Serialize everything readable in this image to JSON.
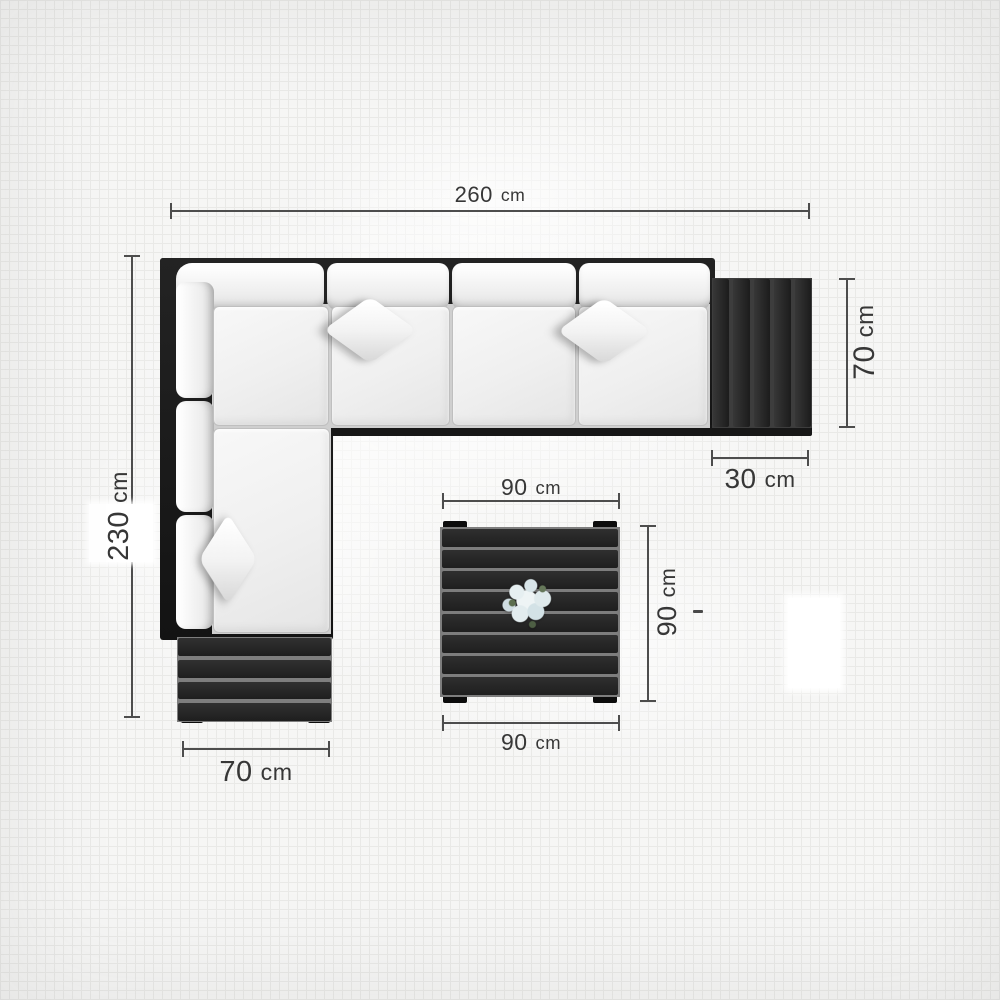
{
  "diagram": {
    "type": "furniture-top-view-dimension-diagram",
    "items": [
      "corner-sofa",
      "side-table",
      "ottoman-bench",
      "coffee-table",
      "flower-bouquet"
    ],
    "colors": {
      "background": "#f6f6f5",
      "grid_line": "#e9e9e7",
      "frame_black": "#1a1a1a",
      "cushion_white": "#f2f2f2",
      "slat_gap_gray": "#7d7d7d",
      "dimension_line": "#4d4d4d",
      "label_text": "#373737",
      "flower_pale_blue": "#dfeaec",
      "flower_green": "#5c6e4e"
    },
    "labels": {
      "sofa_total_width": {
        "value": "260",
        "unit": "cm"
      },
      "sofa_total_depth_left": {
        "value": "230",
        "unit": "cm"
      },
      "side_table_depth": {
        "value": "70",
        "unit": "cm"
      },
      "side_table_width": {
        "value": "30",
        "unit": "cm"
      },
      "bench_width": {
        "value": "70",
        "unit": "cm"
      },
      "coffee_table_width_top": {
        "value": "90",
        "unit": "cm"
      },
      "coffee_table_width_bottom": {
        "value": "90",
        "unit": "cm"
      },
      "coffee_table_depth": {
        "value": "90",
        "unit": "cm"
      }
    }
  }
}
